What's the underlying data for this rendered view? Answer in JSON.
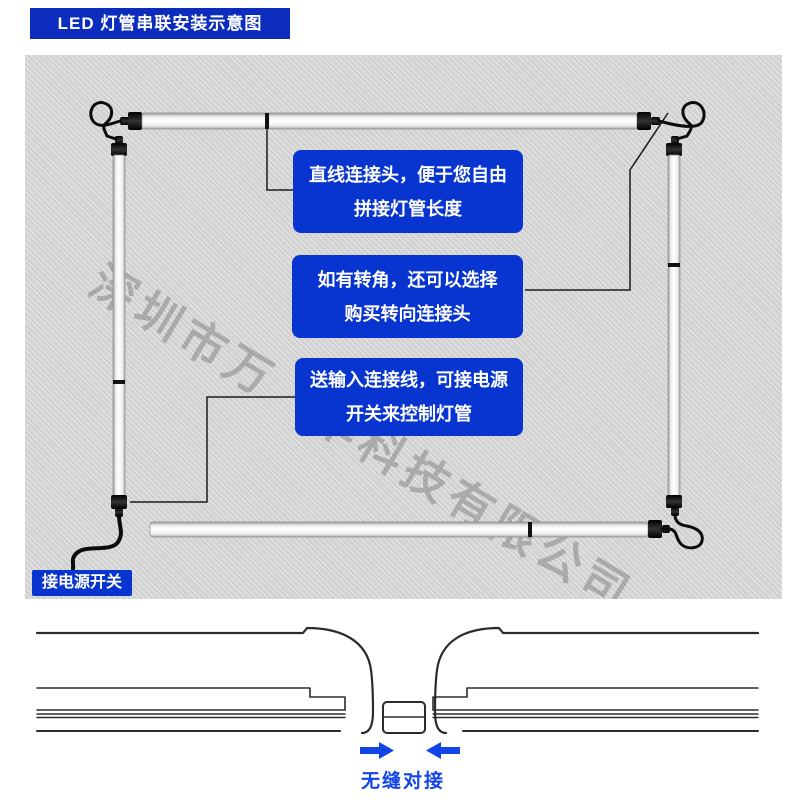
{
  "title": "LED 灯管串联安装示意图",
  "watermark": "深圳市万　华科技有限公司",
  "callouts": [
    {
      "line1": "直线连接头，便于您自由",
      "line2": "拼接灯管长度"
    },
    {
      "line1": "如有转角，还可以选择",
      "line2": "购买转向连接头"
    },
    {
      "line1": "送输入连接线，可接电源",
      "line2": "开关来控制灯管"
    }
  ],
  "power_label": "接电源开关",
  "seam_caption": "无缝对接",
  "colors": {
    "badge_blue": "#0b2cbd",
    "callout_blue": "#0834cf",
    "caption_blue": "#1245e8",
    "panel_gray": "#d6d6d6"
  }
}
